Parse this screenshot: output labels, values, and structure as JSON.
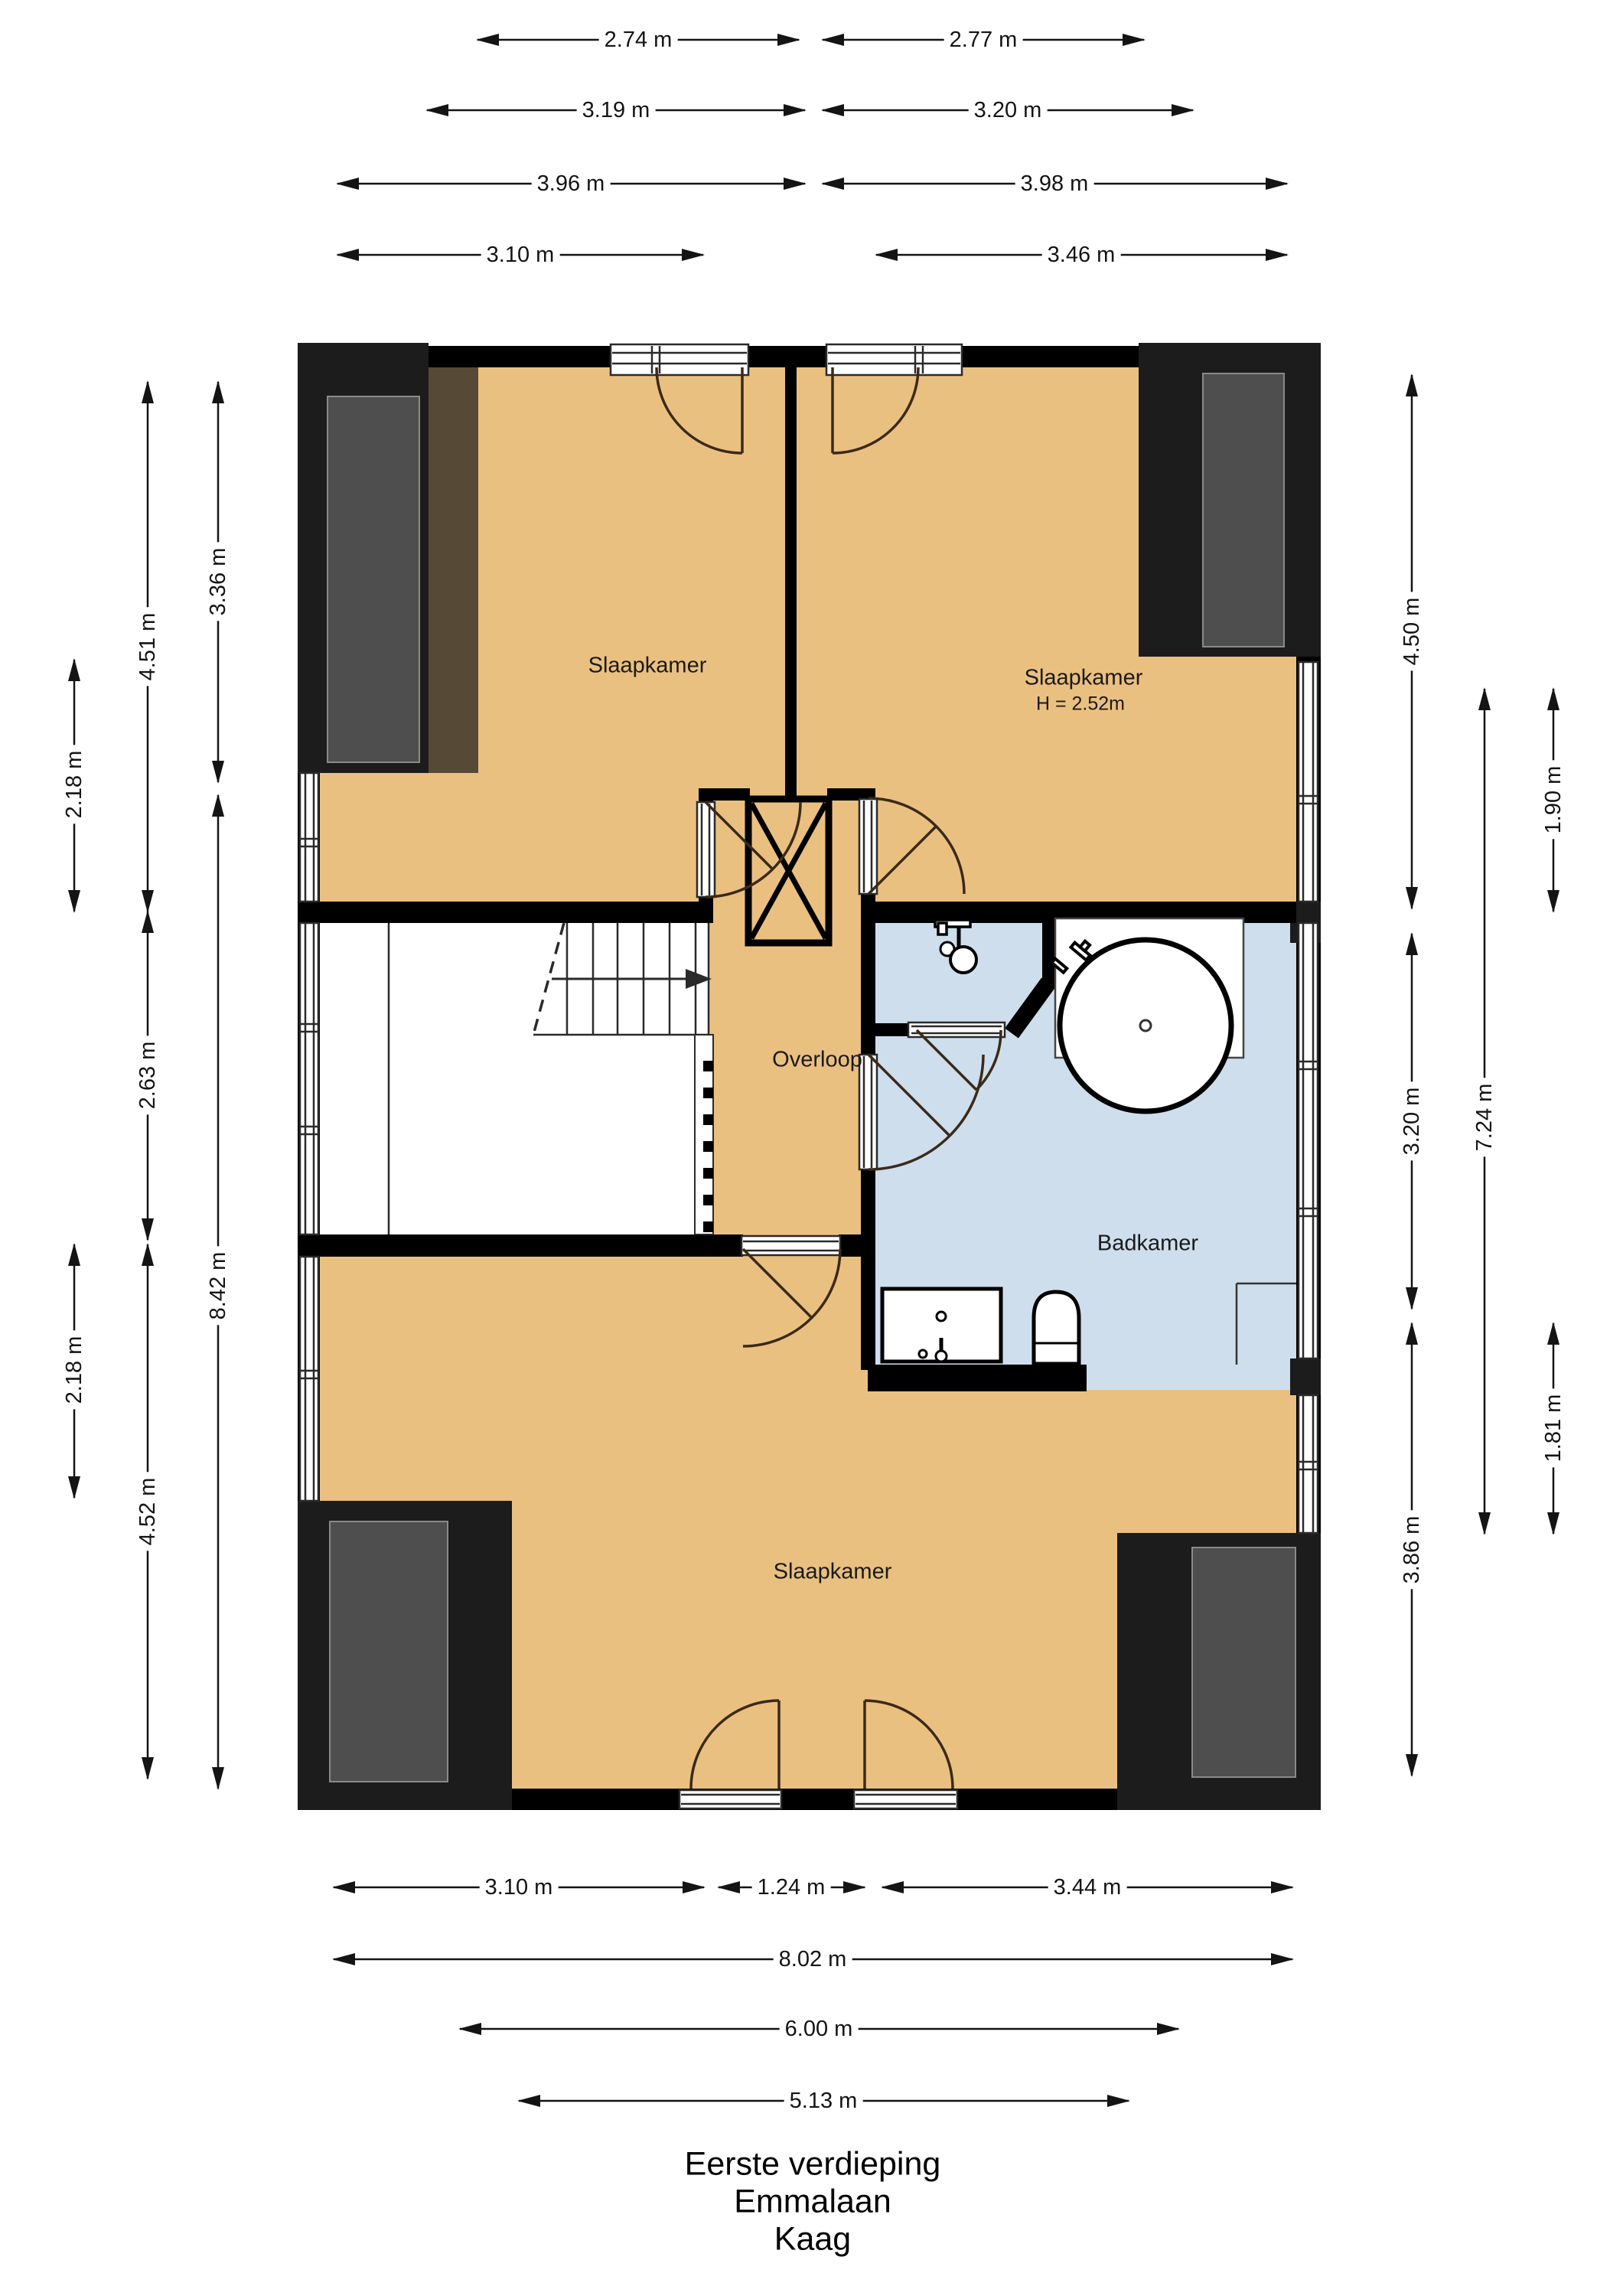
{
  "title": {
    "line1": "Eerste verdieping",
    "line2": "Emmalaan",
    "line3": "Kaag"
  },
  "rooms": {
    "bedroom_top_left": "Slaapkamer",
    "bedroom_top_right": "Slaapkamer",
    "bedroom_top_right_height": "H = 2.52m",
    "landing": "Overloop",
    "bathroom": "Badkamer",
    "bedroom_bottom": "Slaapkamer"
  },
  "dimensions": {
    "top_274": {
      "label": "2.74 m"
    },
    "top_277": {
      "label": "2.77 m"
    },
    "top_319": {
      "label": "3.19 m"
    },
    "top_320": {
      "label": "3.20 m"
    },
    "top_396": {
      "label": "3.96 m"
    },
    "top_398": {
      "label": "3.98 m"
    },
    "top_310": {
      "label": "3.10 m"
    },
    "top_346": {
      "label": "3.46 m"
    },
    "left_218a": {
      "label": "2.18 m"
    },
    "left_451": {
      "label": "4.51 m"
    },
    "left_336": {
      "label": "3.36 m"
    },
    "left_263": {
      "label": "2.63 m"
    },
    "left_842": {
      "label": "8.42 m"
    },
    "left_218b": {
      "label": "2.18 m"
    },
    "left_452": {
      "label": "4.52 m"
    },
    "right_450": {
      "label": "4.50 m"
    },
    "right_190": {
      "label": "1.90 m"
    },
    "right_320": {
      "label": "3.20 m"
    },
    "right_724": {
      "label": "7.24 m"
    },
    "right_181": {
      "label": "1.81 m"
    },
    "right_386": {
      "label": "3.86 m"
    },
    "bottom_310": {
      "label": "3.10 m"
    },
    "bottom_124": {
      "label": "1.24 m"
    },
    "bottom_344": {
      "label": "3.44 m"
    },
    "bottom_802": {
      "label": "8.02 m"
    },
    "bottom_600": {
      "label": "6.00 m"
    },
    "bottom_513": {
      "label": "5.13 m"
    }
  },
  "colors": {
    "floor_orange": "#EAC081",
    "floor_blue": "#CEDEEC",
    "roof_brown": "#564935",
    "panel_gray": "#4E4E4E",
    "pier_black": "#1C1C1C",
    "wall_black": "#000000"
  }
}
